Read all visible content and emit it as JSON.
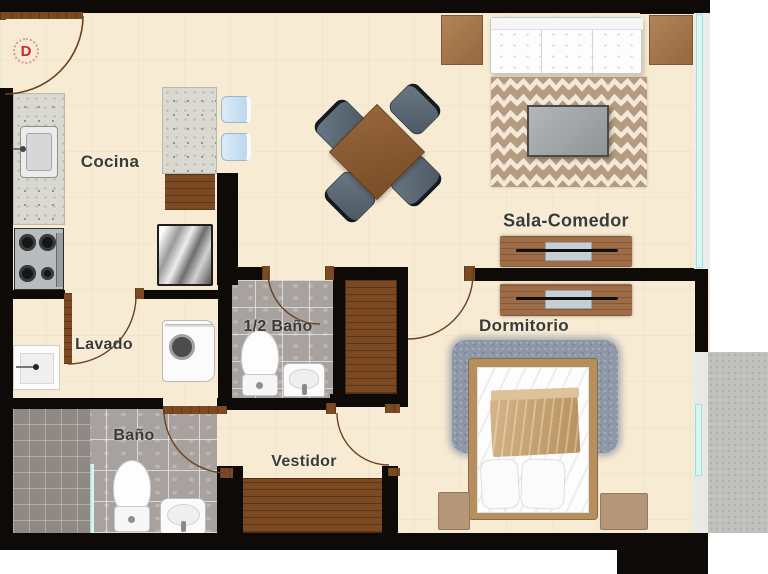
{
  "rooms": {
    "cocina": {
      "label": "Cocina"
    },
    "lavado": {
      "label": "Lavado"
    },
    "bano": {
      "label": "Baño"
    },
    "medio_bano": {
      "label": "1/2 Baño"
    },
    "vestidor": {
      "label": "Vestidor"
    },
    "sala_comedor": {
      "label": "Sala-Comedor"
    },
    "dormitorio": {
      "label": "Dormitorio"
    }
  },
  "entry": {
    "door_label": "D"
  },
  "icons": {
    "stove": "stove-icon",
    "fridge": "fridge-icon",
    "sink": "sink-icon",
    "washer": "washing-machine-icon",
    "toilet": "toilet-icon",
    "shower": "shower-icon",
    "bed": "bed-icon",
    "sofa": "sofa-icon",
    "dining-table": "dining-table-icon",
    "closet": "closet-icon",
    "door-arc": "door-swing-icon",
    "window": "window-icon"
  },
  "colors": {
    "wall": "#0d0a08",
    "floor": "#f7ebd3",
    "wood": "#7b4a22",
    "window_glass": "#d9f6f1",
    "tile_gray": "#a8a29e",
    "terrace_gray": "#c0c0be",
    "entry_red": "#c9282d"
  }
}
